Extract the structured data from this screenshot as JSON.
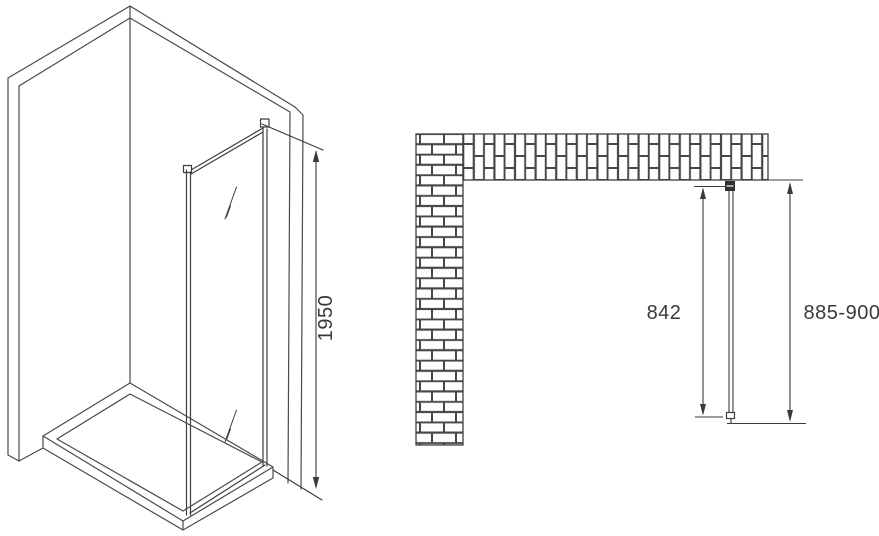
{
  "drawing": {
    "title": "shower-side-panel-technical-drawing",
    "side_view": {
      "height_dimension_label": "1950"
    },
    "plan_view": {
      "glass_width_dimension_label": "842",
      "overall_width_dimension_label": "885-900"
    }
  },
  "colors": {
    "background": "#ffffff",
    "drawing_line": "#4a4a4a",
    "dimension_line": "#3a3a3a",
    "glass_profile": "#3d3d3d",
    "bracket_fill": "#2f2f2f",
    "brick_joint": "#474747"
  }
}
